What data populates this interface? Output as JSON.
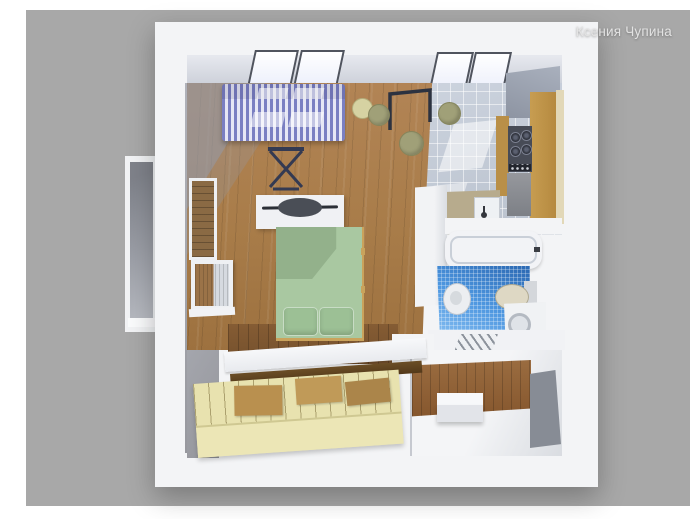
{
  "watermark": {
    "text": "Ксения Чупина"
  },
  "palette": {
    "background_gray": "#a8a8a8",
    "wall_white": "#f3f4f6",
    "wood_floor": "#a87c49",
    "sofa_stripe_blue": "#7a7fc2",
    "sofa_stripe_light": "#e6e7f5",
    "bed_green": "#a9c8a1",
    "pillow_green": "#9cc095",
    "kitchen_tile": "#c4ccd7",
    "cabinet_tan": "#c79d51",
    "stove_dark": "#474b56",
    "bathroom_mosaic_blue": "#4e97e0",
    "hallway_wood": "#9a6c40",
    "drawer_cream": "#e8e2af"
  },
  "scene": {
    "description": "3D top-down render of a studio apartment floor plan",
    "rooms": [
      "living-room",
      "kitchen",
      "bathroom",
      "hallway",
      "storage"
    ],
    "furniture": [
      "striped-sofa",
      "folding-stand",
      "round-stools",
      "dining-rack",
      "bed-with-green-cover",
      "headboard-shelf",
      "wardrobe-partition",
      "stove-with-oven",
      "kitchen-cabinets",
      "kitchen-sink",
      "bathtub",
      "wash-basin",
      "toilet",
      "washing-machine",
      "shoe-bench",
      "storage-drawers",
      "platform-shelf",
      "balcony-opening",
      "left-wall-window"
    ]
  }
}
